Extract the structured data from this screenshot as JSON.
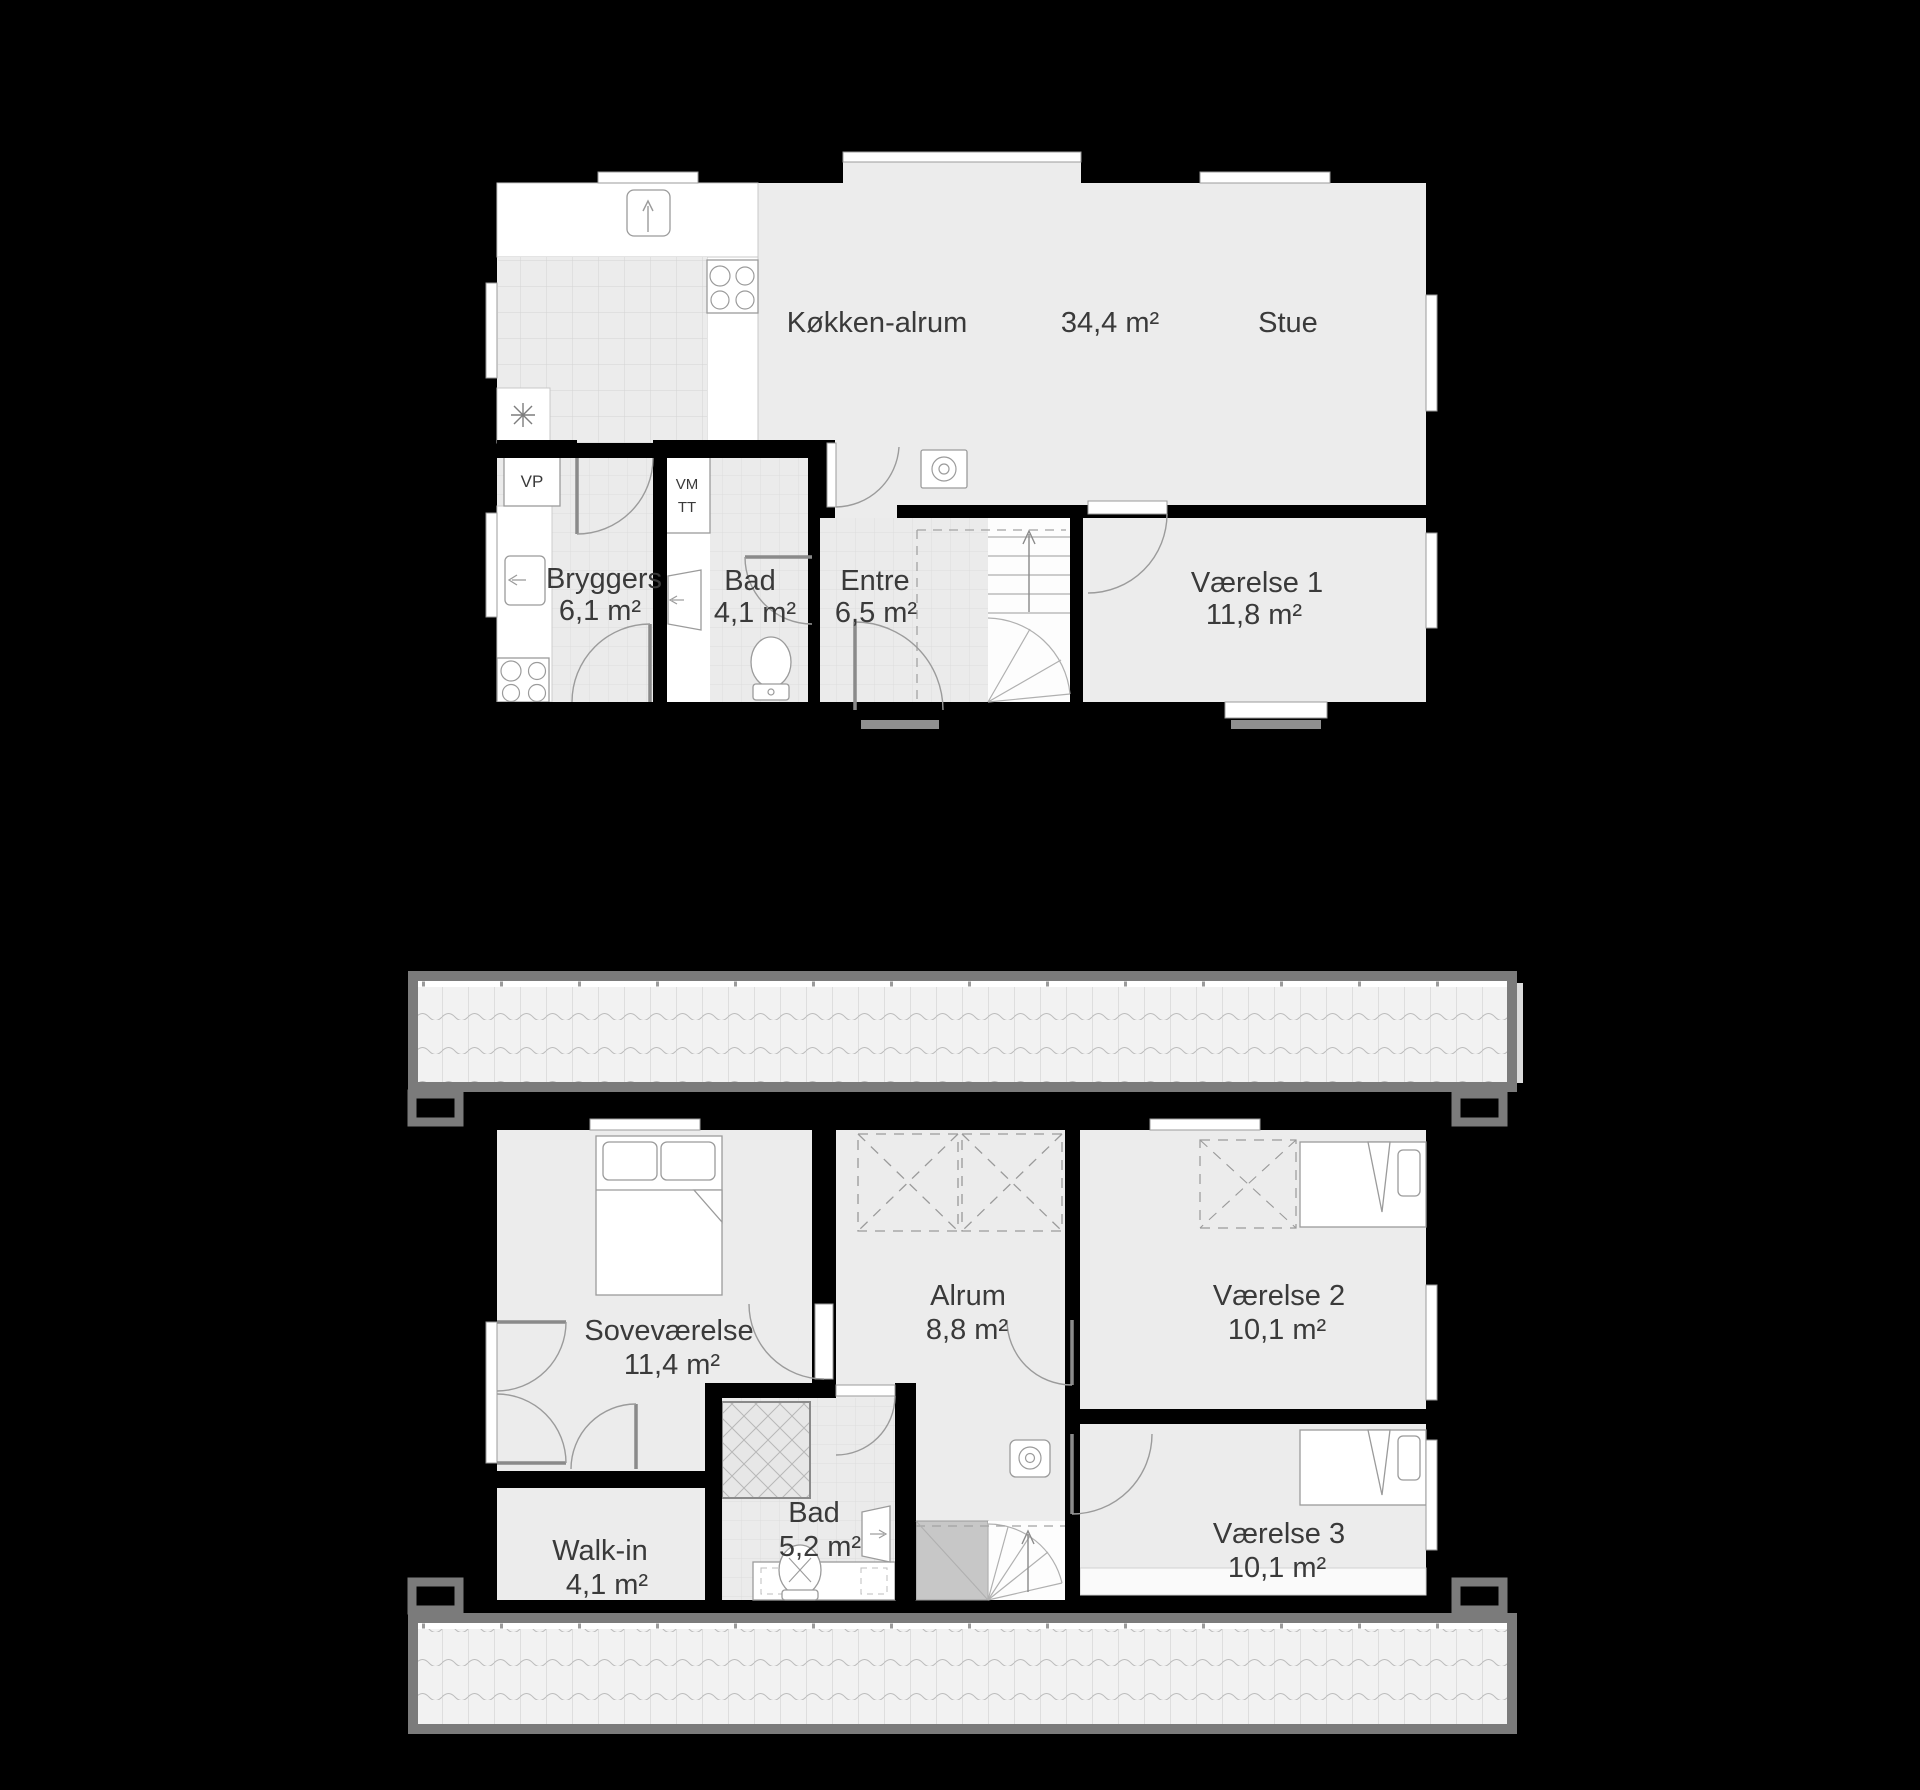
{
  "plans": [
    {
      "id": "ground-floor",
      "rooms": [
        {
          "name": "Køkken-alrum",
          "area": "34,4 m²"
        },
        {
          "name": "Stue"
        },
        {
          "name": "Bryggers",
          "area": "6,1 m²"
        },
        {
          "name": "Bad",
          "area": "4,1 m²"
        },
        {
          "name": "Entre",
          "area": "6,5 m²"
        },
        {
          "name": "Værelse 1",
          "area": "11,8 m²"
        }
      ],
      "labels": {
        "vp": "VP",
        "vm": "VM",
        "tt": "TT"
      }
    },
    {
      "id": "first-floor",
      "rooms": [
        {
          "name": "Soveværelse",
          "area": "11,4 m²"
        },
        {
          "name": "Alrum",
          "area": "8,8 m²"
        },
        {
          "name": "Værelse 2",
          "area": "10,1 m²"
        },
        {
          "name": "Værelse 3",
          "area": "10,1 m²"
        },
        {
          "name": "Walk-in",
          "area": "4,1 m²"
        },
        {
          "name": "Bad",
          "area": "5,2 m²"
        }
      ]
    }
  ],
  "colors": {
    "background": "#000000",
    "floor": "#ececec",
    "wall": "#000000",
    "roof_border": "#7b7b7b",
    "roof_tile": "#f2f2f2",
    "threshold": "#8f8f8f",
    "stair_landing": "#c7c7c7",
    "label_text": "#3a3a3a"
  }
}
